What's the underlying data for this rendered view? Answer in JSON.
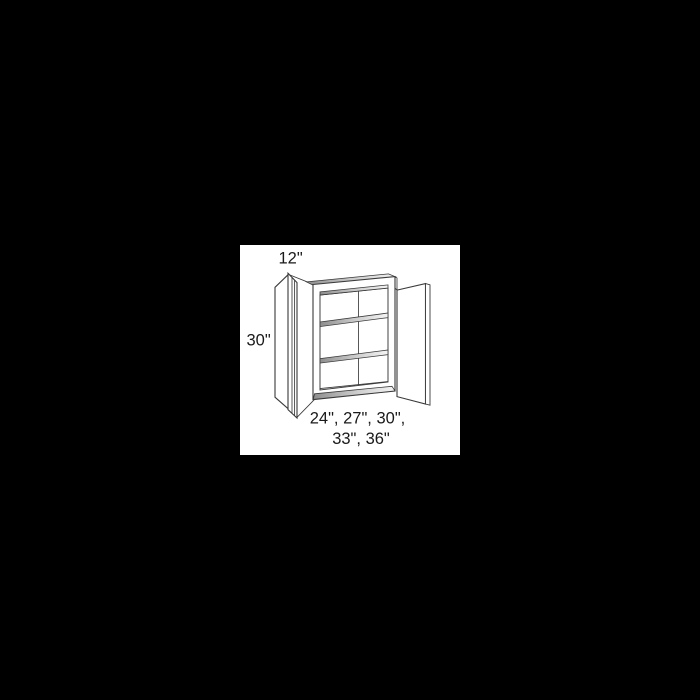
{
  "window": {
    "background_color": "#000000"
  },
  "panel": {
    "background_color": "#ffffff"
  },
  "diagram": {
    "subject": "wall cabinet line drawing, two doors open, two interior shelves",
    "line_color": "#3a3a3a",
    "text_color": "#1a1a1a",
    "labels": {
      "depth": "12\"",
      "height": "30\"",
      "widths_line1": "24\", 27\", 30\",",
      "widths_line2": "33\", 36\""
    },
    "dimensions": {
      "depth_inches": 12,
      "height_inches": 30,
      "available_widths_inches": [
        24,
        27,
        30,
        33,
        36
      ]
    }
  }
}
